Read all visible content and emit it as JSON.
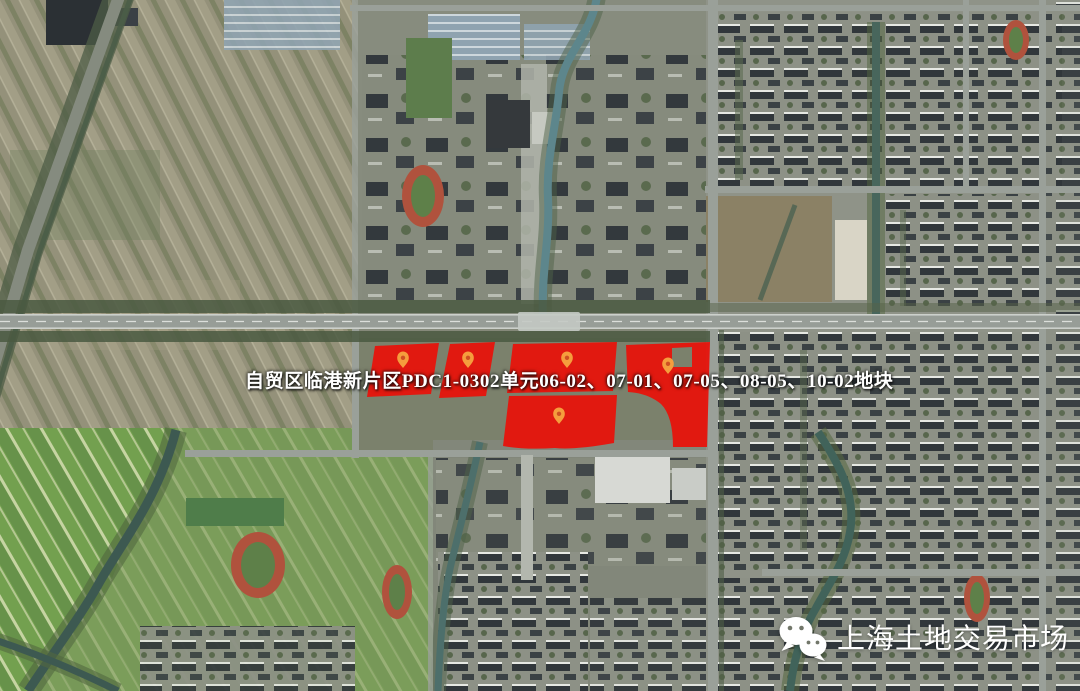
{
  "map": {
    "title_label": "自贸区临港新片区PDC1-0302单元06-02、07-01、07-05、08-05、10-02地块",
    "district": "自贸区临港新片区",
    "planning_unit": "PDC1-0302",
    "parcel_ids": [
      "06-02",
      "07-01",
      "07-05",
      "08-05",
      "10-02"
    ],
    "pin_count": 5
  },
  "watermark": {
    "text": "上海土地交易市场",
    "icon": "wechat-icon"
  },
  "colors": {
    "parcel_highlight": "#e7130c",
    "pin_body": "#f59d3d",
    "pin_dot": "#cf4f22",
    "label_text": "#ffffff",
    "watermark_text": "#ffffff"
  }
}
